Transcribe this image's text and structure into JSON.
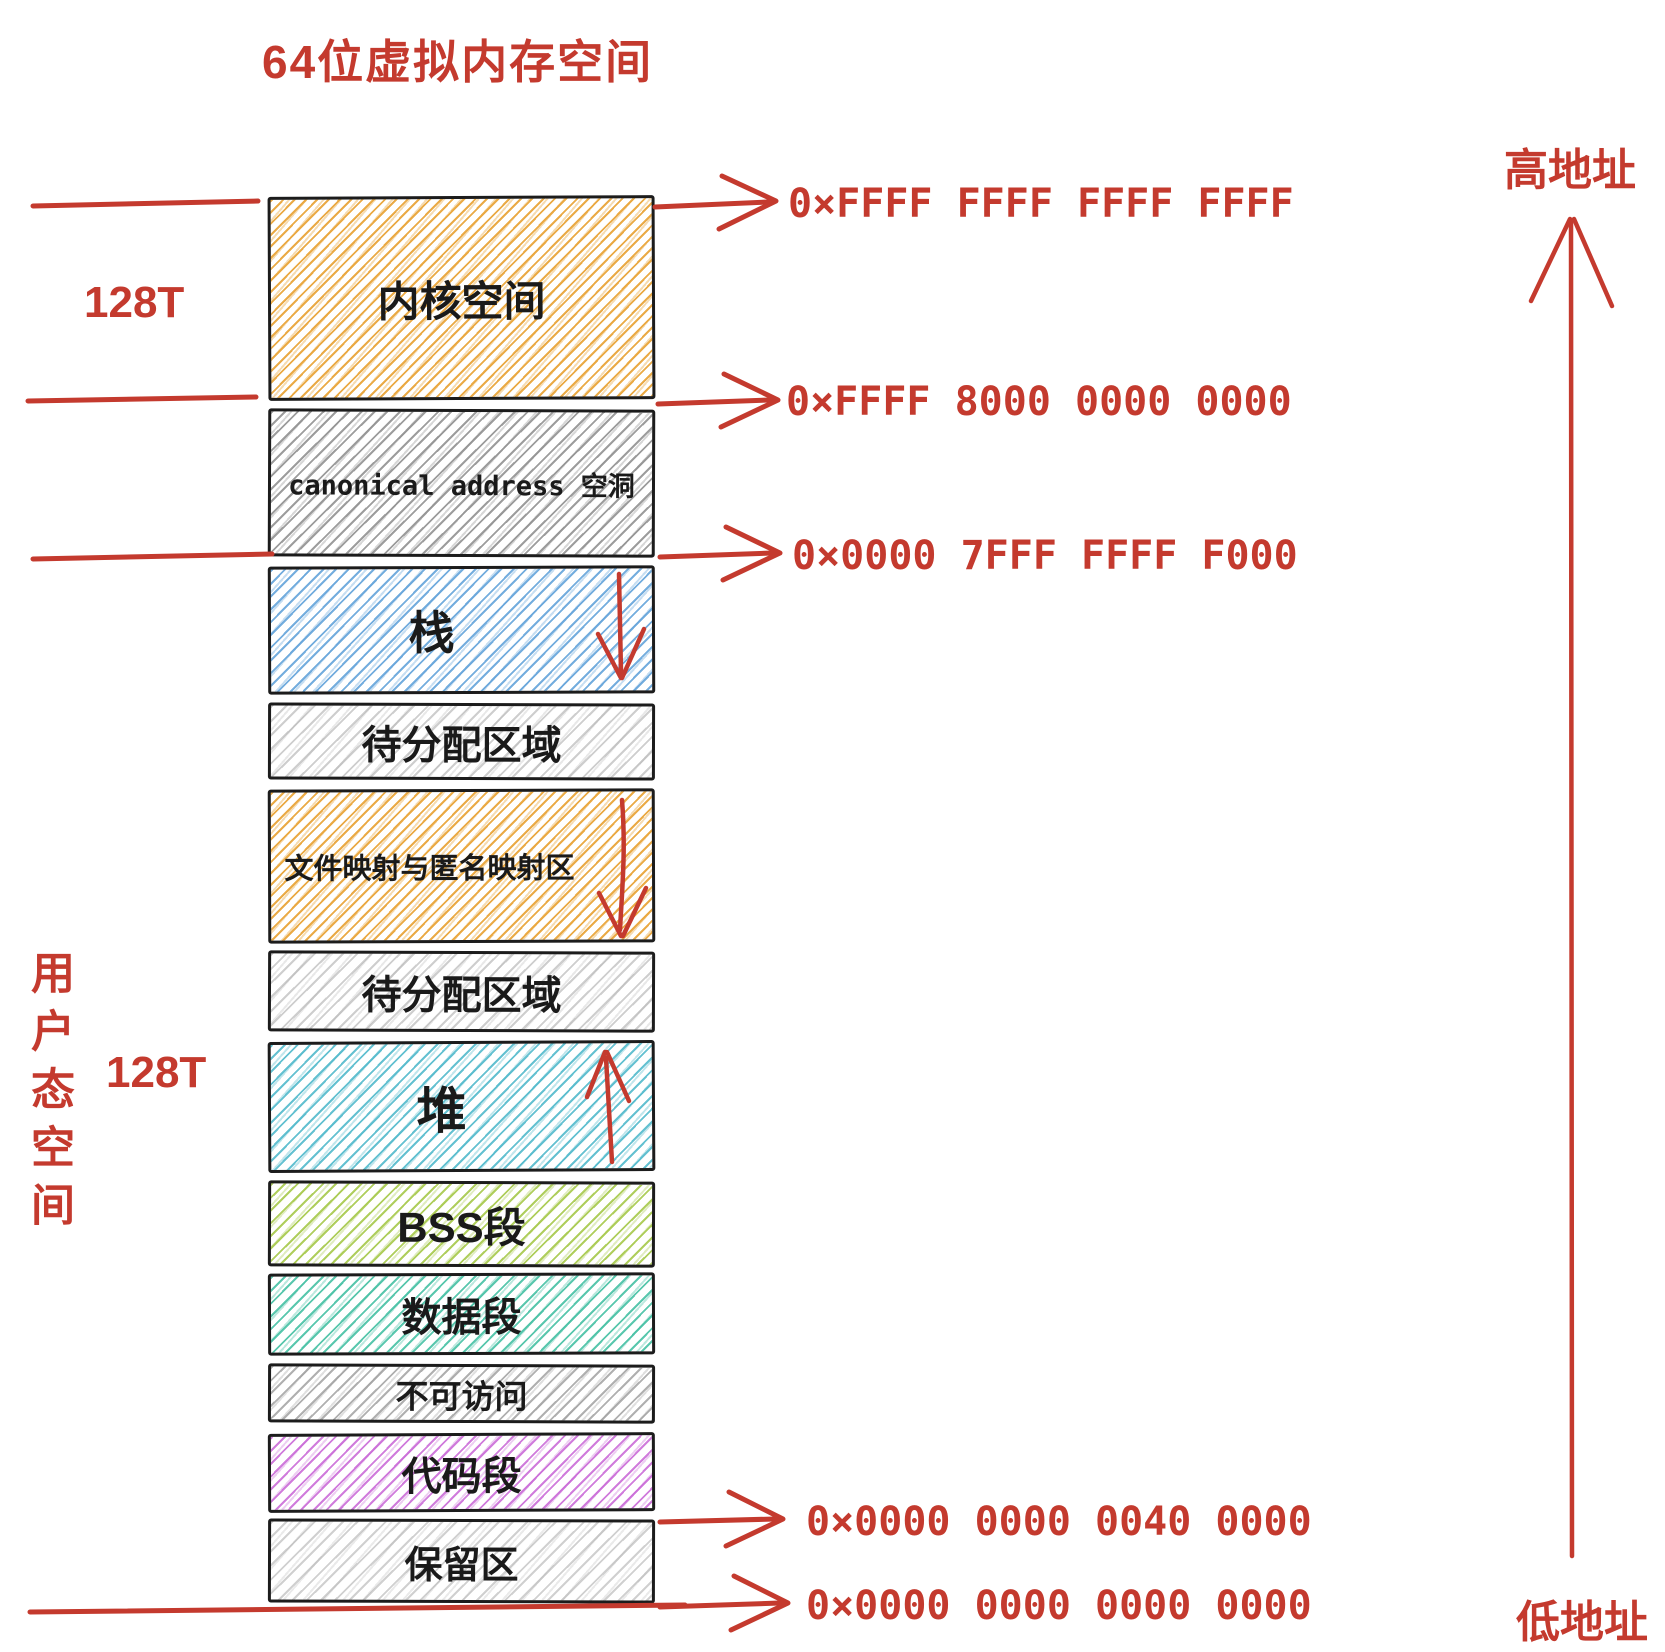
{
  "title": "64位虚拟内存空间",
  "accent_red": "#c43a2e",
  "side": {
    "kernel_size": "128T",
    "user_size": "128T",
    "user_space": "用户态空间"
  },
  "axis": {
    "high": "高地址",
    "low": "低地址"
  },
  "regions": [
    {
      "id": "kernel",
      "label": "内核空间",
      "color": "#E9A63C",
      "growth": null
    },
    {
      "id": "canonical-hole",
      "label": "canonical address 空洞",
      "color": "#8C8C8C",
      "growth": null
    },
    {
      "id": "stack",
      "label": "栈",
      "color": "#5C9FD8",
      "growth": "down"
    },
    {
      "id": "unallocated-upper",
      "label": "待分配区域",
      "color": "#A5A5A5",
      "growth": null
    },
    {
      "id": "mmap",
      "label": "文件映射与匿名映射区",
      "color": "#E9A63C",
      "growth": "down"
    },
    {
      "id": "unallocated-lower",
      "label": "待分配区域",
      "color": "#A5A5A5",
      "growth": null
    },
    {
      "id": "heap",
      "label": "堆",
      "color": "#49B6C9",
      "growth": "up"
    },
    {
      "id": "bss",
      "label": "BSS段",
      "color": "#A6C94B",
      "growth": null
    },
    {
      "id": "data",
      "label": "数据段",
      "color": "#3CBD9F",
      "growth": null
    },
    {
      "id": "no-access",
      "label": "不可访问",
      "color": "#969696",
      "growth": null
    },
    {
      "id": "code",
      "label": "代码段",
      "color": "#C45BD3",
      "growth": null
    },
    {
      "id": "reserved",
      "label": "保留区",
      "color": "#AAAAAA",
      "growth": null
    }
  ],
  "addresses": [
    "0×FFFF FFFF FFFF FFFF",
    "0×FFFF 8000 0000 0000",
    "0×0000 7FFF FFFF F000",
    "0×0000 0000 0040 0000",
    "0×0000 0000 0000 0000"
  ]
}
